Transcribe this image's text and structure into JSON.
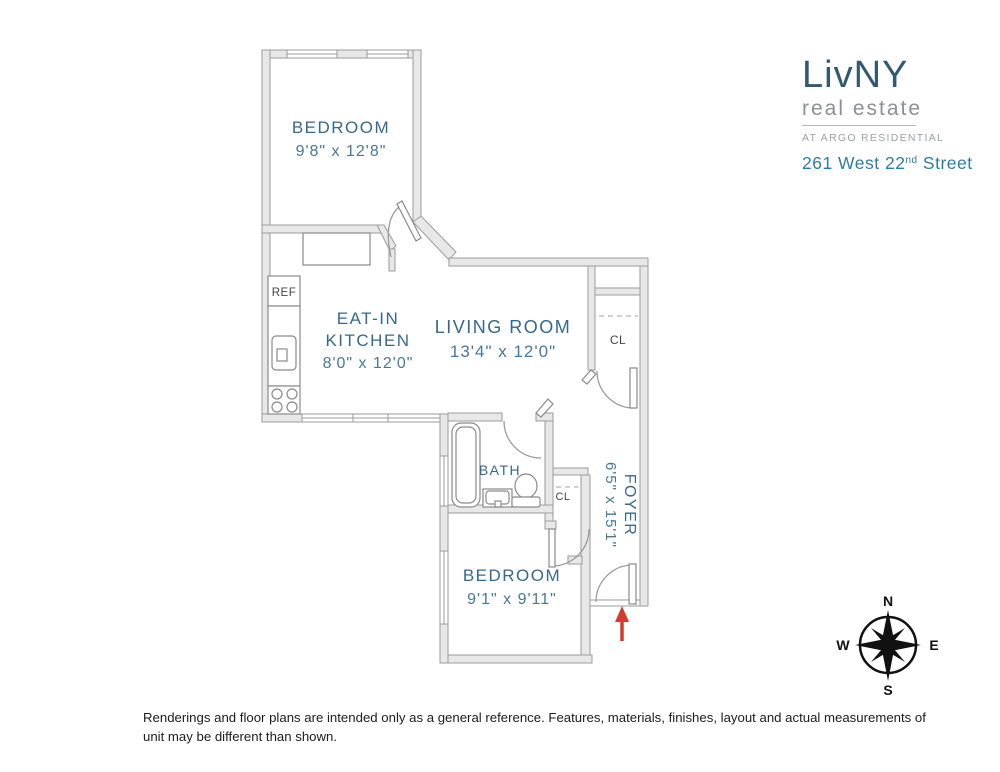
{
  "logo": {
    "brand": "LivNY",
    "tagline": "real estate",
    "subtitle": "AT ARGO RESIDENTIAL",
    "address_prefix": "261 West 22",
    "address_sup": "nd",
    "address_suffix": " Street"
  },
  "rooms": {
    "bedroom1": {
      "name": "BEDROOM",
      "dims": "9'8\" x 12'8\""
    },
    "kitchen": {
      "name_line1": "EAT-IN",
      "name_line2": "KITCHEN",
      "dims": "8'0\" x 12'0\""
    },
    "living": {
      "name": "LIVING ROOM",
      "dims": "13'4\" x 12'0\""
    },
    "bath": {
      "name": "BATH"
    },
    "foyer": {
      "name": "FOYER",
      "dims": "6'5\" x 15'1\""
    },
    "bedroom2": {
      "name": "BEDROOM",
      "dims": "9'1\" x 9'11\""
    },
    "closet1": {
      "name": "CL"
    },
    "closet2": {
      "name": "CL"
    },
    "fridge": {
      "name": "REF"
    }
  },
  "compass": {
    "n": "N",
    "e": "E",
    "s": "S",
    "w": "W"
  },
  "disclaimer": "Renderings and floor plans are intended only as a general reference. Features, materials, finishes, layout and actual measurements of unit may be different than shown.",
  "colors": {
    "room_label": "#36688c",
    "room_dims": "#47789a",
    "wall_fill": "#e8e8e8",
    "wall_stroke": "#9b9b9b",
    "entry_arrow": "#d63a2c",
    "brand": "#33596e",
    "address": "#2b7da1"
  }
}
